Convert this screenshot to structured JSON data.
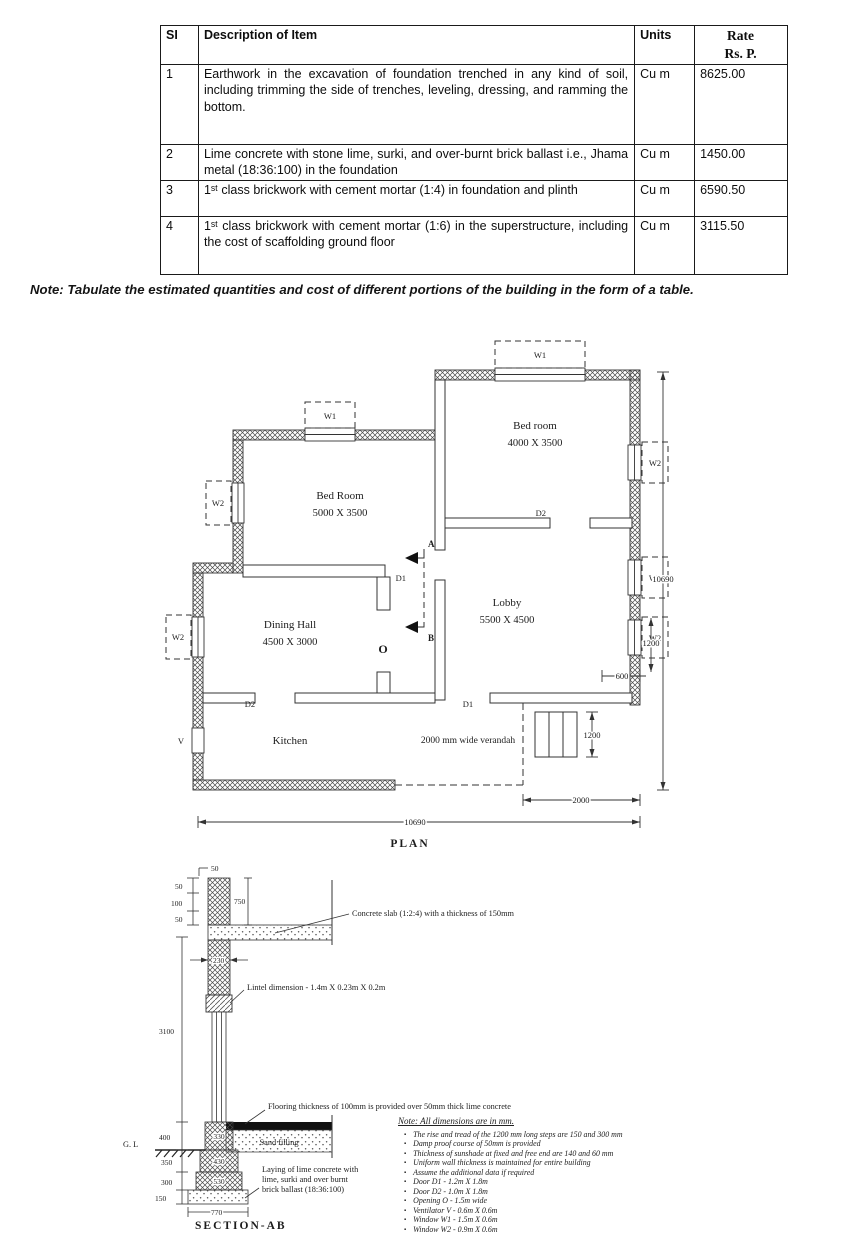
{
  "table": {
    "headers": {
      "si": "SI",
      "description": "Description of Item",
      "units": "Units",
      "rate_line1": "Rate",
      "rate_line2": "Rs. P."
    },
    "rows": [
      {
        "si": "1",
        "description": "Earthwork in the excavation of foundation trenched in any kind of soil, including trimming the side of trenches, leveling, dressing, and ramming the bottom.",
        "units": "Cu m",
        "rate": "8625.00"
      },
      {
        "si": "2",
        "description": "Lime concrete with stone lime, surki, and over-burnt brick ballast i.e., Jhama metal (18:36:100) in the foundation",
        "units": "Cu m",
        "rate": "1450.00"
      },
      {
        "si": "3",
        "description": "1ˢᵗ class brickwork with cement mortar (1:4) in foundation and plinth",
        "units": "Cu m",
        "rate": "6590.50"
      },
      {
        "si": "4",
        "description": "1ˢᵗ class brickwork with cement mortar (1:6) in the superstructure, including the cost of scaffolding ground floor",
        "units": "Cu m",
        "rate": "3115.50"
      }
    ]
  },
  "note": "Note: Tabulate the estimated quantities and cost of different portions of the building in the form  of a table.",
  "plan": {
    "title": "PLAN",
    "rooms": {
      "bed1": {
        "name": "Bed room",
        "size": "4000 X 3500"
      },
      "bed2": {
        "name": "Bed Room",
        "size": "5000 X 3500"
      },
      "dining": {
        "name": "Dining Hall",
        "size": "4500 X 3000"
      },
      "lobby": {
        "name": "Lobby",
        "size": "5500 X 4500"
      },
      "kitchen": {
        "name": "Kitchen"
      },
      "verandah": {
        "name": "2000 mm wide verandah"
      }
    },
    "labels": {
      "w1": "W1",
      "w2": "W2",
      "d1": "D1",
      "d2": "D2",
      "o": "O",
      "v": "V",
      "a": "A",
      "b": "B"
    },
    "dims": {
      "overall": "10690",
      "verandah": "2000",
      "steps": "1200",
      "window": "1200",
      "offset": "600"
    }
  },
  "section": {
    "title": "SECTION-AB",
    "gl": "G. L",
    "sand": "Sand filling",
    "annotations": {
      "slab": "Concrete slab (1:2:4) with a thickness of 150mm",
      "lintel": "Lintel dimension - 1.4m X 0.23m X 0.2m",
      "flooring": "Flooring thickness of 100mm is provided over 50mm thick lime concrete",
      "laying1": "Laying of lime concrete with",
      "laying2": "lime, surki and over burnt",
      "laying3": "brick ballast (18:36:100)"
    },
    "dims": {
      "p50a": "50",
      "p50b": "50",
      "p100": "100",
      "p50c": "50",
      "p750": "750",
      "wall": "230",
      "height": "3100",
      "plinth": "400",
      "s350": "350",
      "s300": "300",
      "s150": "150",
      "bed": "770",
      "step1": "330",
      "step2": "430",
      "step3": "530"
    }
  },
  "section_notes": {
    "title": "Note: All dimensions are in mm.",
    "items": [
      "The rise and tread of the 1200 mm long steps are 150 and 300 mm",
      "Damp proof course of 50mm is provided",
      "Thickness of sunshade at fixed and free end are 140 and 60 mm",
      "Uniform wall thickness is maintained for entire building",
      "Assume the additional data if  required",
      "Door D1 - 1.2m X 1.8m",
      "Door D2 - 1.0m X 1.8m",
      "Opening O - 1.5m wide",
      "Ventilator V - 0.6m X 0.6m",
      "Window W1 - 1.5m X 0.6m",
      "Window W2 - 0.9m X 0.6m"
    ]
  }
}
